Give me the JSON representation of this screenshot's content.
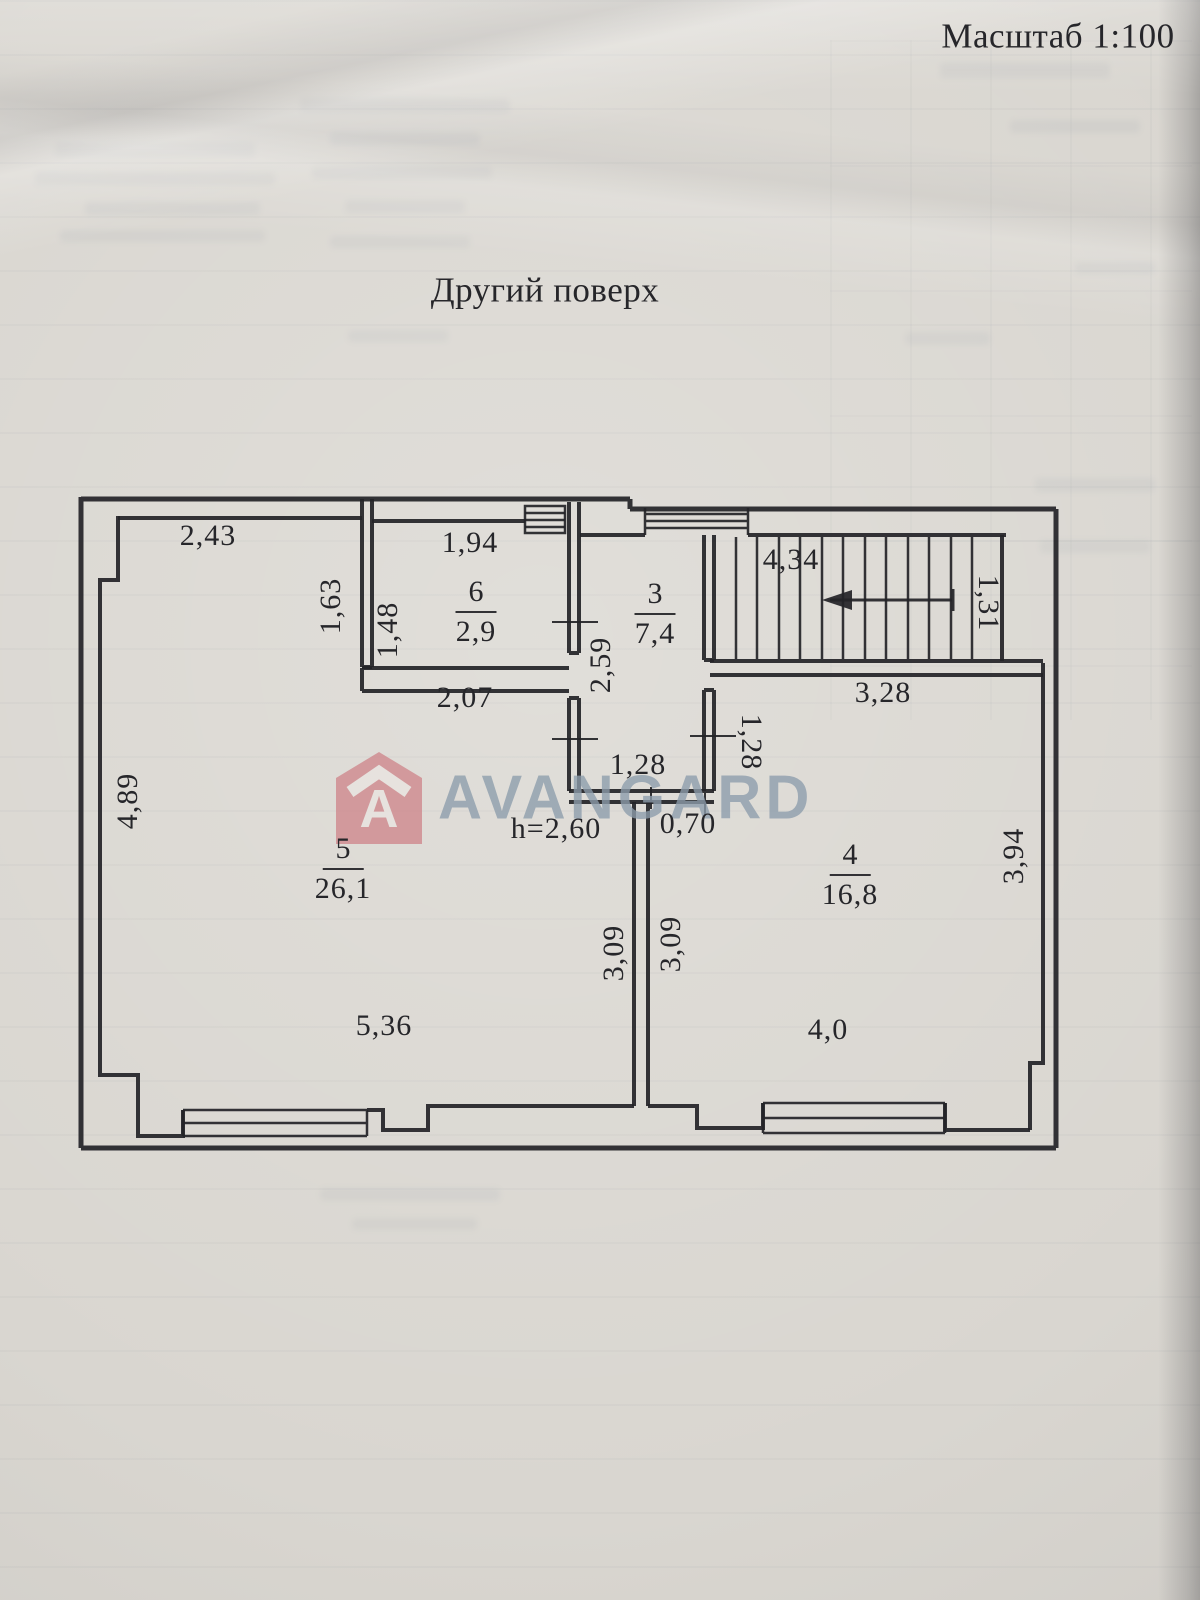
{
  "page": {
    "scale_note": "Масштаб 1:100",
    "title": "Другий поверх",
    "height_note": "h=2,60"
  },
  "watermark": {
    "brand": "AVANGARD",
    "logo_letter": "A"
  },
  "rooms": {
    "r3": {
      "number": "3",
      "area": "7,4"
    },
    "r4": {
      "number": "4",
      "area": "16,8"
    },
    "r5": {
      "number": "5",
      "area": "26,1"
    },
    "r6": {
      "number": "6",
      "area": "2,9"
    }
  },
  "dims": {
    "top_left_width": "2,43",
    "room6_top_width": "1,94",
    "room5_upper_right_height": "1,63",
    "room6_left_height": "1,48",
    "room6_bottom_width": "2,07",
    "hall_height": "2,59",
    "stairs_length": "4,34",
    "stairs_width": "1,31",
    "room4_top_width": "3,28",
    "vestibule_width": "1,28",
    "room4_notch_height": "1,28",
    "door_width": "0,70",
    "room5_left_height": "4,89",
    "room5_bottom_width": "5,36",
    "room5_right_height": "3,09",
    "room4_left_height": "3,09",
    "room4_right_height": "3,94",
    "room4_bottom_width": "4,0"
  },
  "colors": {
    "paper": "#d9d6d0",
    "ink": "#232327",
    "watermark_text": "#8d9dac",
    "watermark_logo": "#cd8187"
  }
}
